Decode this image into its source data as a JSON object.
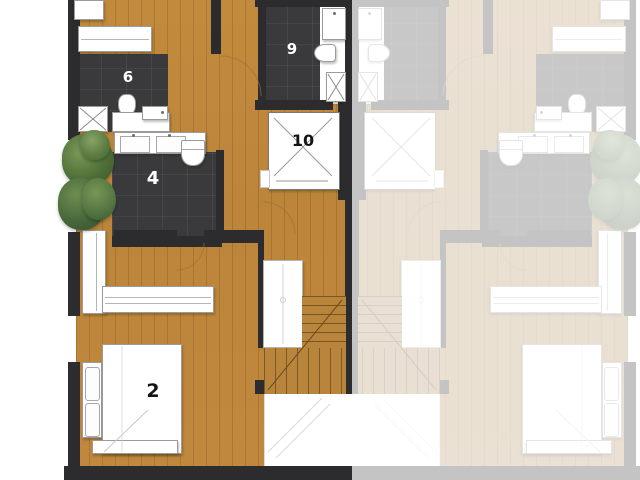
{
  "plan": {
    "title": "duplex-floor-plan",
    "rooms": [
      {
        "id": "room-2",
        "label": "2",
        "type": "bedroom",
        "label_color": "#141414"
      },
      {
        "id": "room-4",
        "label": "4",
        "type": "bathroom",
        "label_color": "#ffffff"
      },
      {
        "id": "room-6",
        "label": "6",
        "type": "wc",
        "label_color": "#ffffff"
      },
      {
        "id": "room-9",
        "label": "9",
        "type": "bathroom",
        "label_color": "#ffffff"
      },
      {
        "id": "room-10",
        "label": "10",
        "type": "elevator-shaft",
        "label_color": "#141414"
      }
    ],
    "units": {
      "left": "active unit (full color)",
      "right": "adjacent mirrored unit (faded)"
    },
    "colors": {
      "background": "#FFFFFF",
      "wood_floor": "#BE873B",
      "dark_tile": "#3A3A3C",
      "wall": "#2C2C2E",
      "fixture_white": "#FFFFFF",
      "fixture_outline": "#9B9B9B",
      "tree_green": "#4F7038",
      "faded_wood": "#EFE0C8",
      "faded_tile": "#CFCDCE"
    },
    "fixtures": [
      "bed",
      "wardrobe",
      "shelf",
      "desk",
      "double-vanity",
      "toilet",
      "shower",
      "bathtub",
      "stairs",
      "terrace",
      "trees",
      "door-arcs"
    ]
  }
}
